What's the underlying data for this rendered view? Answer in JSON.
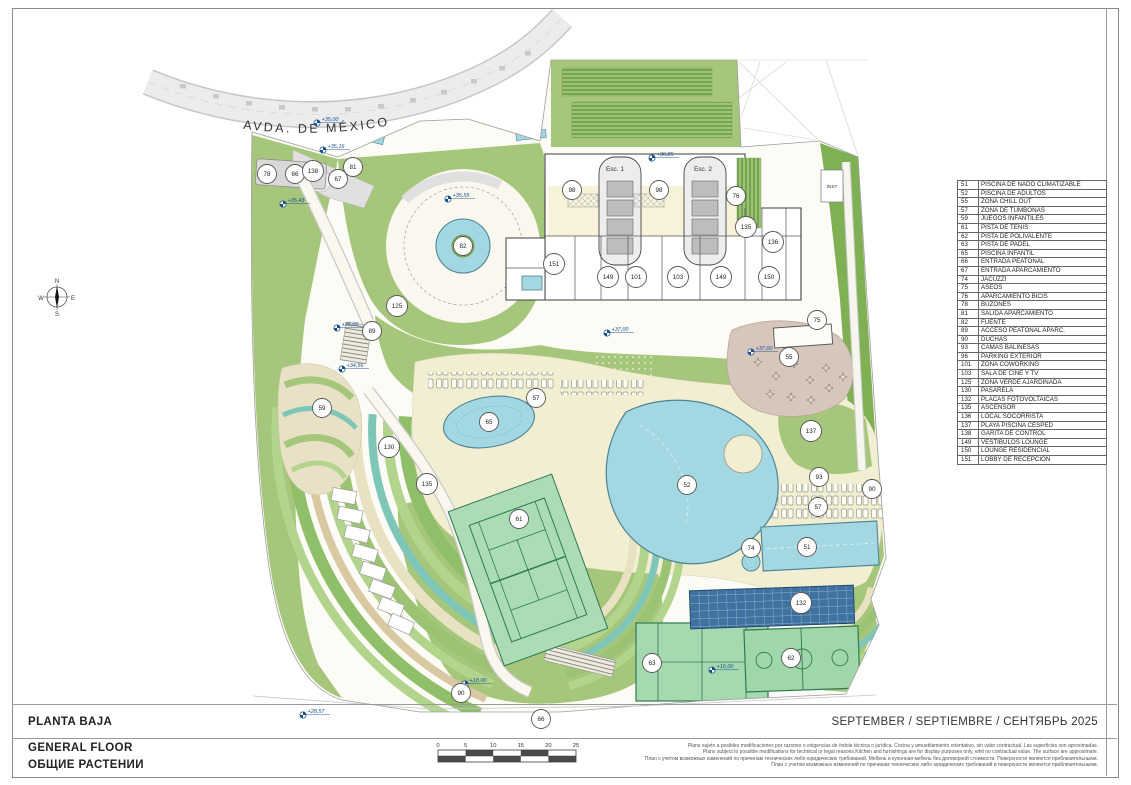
{
  "title_block": {
    "title_es": "PLANTA BAJA",
    "title_en": "GENERAL FLOOR",
    "title_ru": "ОБЩИЕ РАСТЕНИИ",
    "date_line": "SEPTEMBER / SEPTIEMBRE / СЕНТЯБРЬ 2025",
    "disclaimer_es": "Plano sujeto a posibles modificaciones por razones o exigencias de índole técnica o jurídica. Cocina y amueblamiento orientativo, sin valor contractual. Las superficies son aproximadas.",
    "disclaimer_en": "Plans subject to possible modifications for technical or legal reasons.Kitchen and furnishings are for display purposes only, whit no contractual value. The surface are approximate.",
    "disclaimer_ru1": "План с учетом возможных изменений по причинам технических либо юридических требований. Мебель и кухонная мебель без договорной стоимости. Поверхности являются приблизительными.",
    "disclaimer_ru2": "План с учетом возможных изменений по причинам технических либо юридических требований и поверхности являются приблизительными."
  },
  "scale_bar": {
    "ticks": [
      "0",
      "5",
      "10",
      "15",
      "20",
      "25"
    ]
  },
  "legend": {
    "rows": [
      {
        "n": "51",
        "t": "PISCINA DE NADO CLIMATIZABLE"
      },
      {
        "n": "52",
        "t": "PISCINA DE ADULTOS"
      },
      {
        "n": "55",
        "t": "ZONA CHILL OUT"
      },
      {
        "n": "57",
        "t": "ZONA DE TUMBONAS"
      },
      {
        "n": "59",
        "t": "JUEGOS INFANTILES"
      },
      {
        "n": "61",
        "t": "PISTA DE TENIS"
      },
      {
        "n": "62",
        "t": "PISTA DE POLIVALENTE"
      },
      {
        "n": "63",
        "t": "PISTA DE PADEL"
      },
      {
        "n": "65",
        "t": "PISCINA INFANTIL"
      },
      {
        "n": "66",
        "t": "ENTRADA PEATONAL"
      },
      {
        "n": "67",
        "t": "ENTRADA APARCAMIENTO"
      },
      {
        "n": "74",
        "t": "JACUZZI"
      },
      {
        "n": "75",
        "t": "ASEOS"
      },
      {
        "n": "76",
        "t": "APARCAMIENTO BICIS"
      },
      {
        "n": "78",
        "t": "BUZONES"
      },
      {
        "n": "81",
        "t": "SALIDA APARCAMIENTO"
      },
      {
        "n": "82",
        "t": "FUENTE"
      },
      {
        "n": "89",
        "t": "ACCESO PEATONAL APARC."
      },
      {
        "n": "90",
        "t": "DUCHAS"
      },
      {
        "n": "93",
        "t": "CAMAS BALINESAS"
      },
      {
        "n": "96",
        "t": "PARKING EXTERIOR"
      },
      {
        "n": "101",
        "t": "ZONA COWORKING"
      },
      {
        "n": "103",
        "t": "SALA DE CINE Y TV"
      },
      {
        "n": "125",
        "t": "ZONA VERDE AJARDINADA"
      },
      {
        "n": "130",
        "t": "PASARELA"
      },
      {
        "n": "132",
        "t": "PLACAS FOTOVOLTAICAS"
      },
      {
        "n": "135",
        "t": "ASCENSOR"
      },
      {
        "n": "136",
        "t": "LOCAL SOCORRISTA"
      },
      {
        "n": "137",
        "t": "PLAYA PISCINA CESPED"
      },
      {
        "n": "138",
        "t": "GARITA DE CONTROL"
      },
      {
        "n": "149",
        "t": "VESTÍBULOS LOUNGE"
      },
      {
        "n": "150",
        "t": "LOUNGE RESIDENCIAL"
      },
      {
        "n": "151",
        "t": "LOBBY DE RECEPCIÓN"
      }
    ]
  },
  "plan": {
    "street_label": "AVDA.  DE  MÉXICO",
    "compass": {
      "n": "N",
      "e": "E",
      "s": "S",
      "w": "W"
    },
    "labels": [
      {
        "t": "Esc. 1",
        "x": 615,
        "y": 171,
        "s": 6.5
      },
      {
        "t": "Esc. 2",
        "x": 703,
        "y": 171,
        "s": 6.5
      },
      {
        "t": "INST",
        "x": 832,
        "y": 188,
        "s": 4.8
      }
    ],
    "markers": [
      {
        "n": "78",
        "x": 267,
        "y": 174
      },
      {
        "n": "66",
        "x": 295,
        "y": 174
      },
      {
        "n": "138",
        "x": 313,
        "y": 171
      },
      {
        "n": "67",
        "x": 338,
        "y": 179
      },
      {
        "n": "81",
        "x": 353,
        "y": 167
      },
      {
        "n": "98",
        "x": 572,
        "y": 190
      },
      {
        "n": "98",
        "x": 659,
        "y": 190
      },
      {
        "n": "76",
        "x": 736,
        "y": 196
      },
      {
        "n": "135",
        "x": 746,
        "y": 227
      },
      {
        "n": "136",
        "x": 773,
        "y": 242
      },
      {
        "n": "151",
        "x": 554,
        "y": 264
      },
      {
        "n": "149",
        "x": 608,
        "y": 277
      },
      {
        "n": "101",
        "x": 636,
        "y": 277
      },
      {
        "n": "103",
        "x": 678,
        "y": 277
      },
      {
        "n": "149",
        "x": 721,
        "y": 277
      },
      {
        "n": "150",
        "x": 769,
        "y": 277
      },
      {
        "n": "82",
        "x": 463,
        "y": 246
      },
      {
        "n": "125",
        "x": 397,
        "y": 306
      },
      {
        "n": "89",
        "x": 372,
        "y": 331
      },
      {
        "n": "75",
        "x": 817,
        "y": 320
      },
      {
        "n": "55",
        "x": 789,
        "y": 357
      },
      {
        "n": "59",
        "x": 322,
        "y": 408
      },
      {
        "n": "57",
        "x": 536,
        "y": 398
      },
      {
        "n": "65",
        "x": 489,
        "y": 422
      },
      {
        "n": "137",
        "x": 811,
        "y": 431
      },
      {
        "n": "130",
        "x": 389,
        "y": 447
      },
      {
        "n": "135",
        "x": 427,
        "y": 484
      },
      {
        "n": "52",
        "x": 687,
        "y": 485
      },
      {
        "n": "93",
        "x": 819,
        "y": 477
      },
      {
        "n": "90",
        "x": 872,
        "y": 489
      },
      {
        "n": "57",
        "x": 818,
        "y": 507
      },
      {
        "n": "74",
        "x": 751,
        "y": 548
      },
      {
        "n": "51",
        "x": 807,
        "y": 547
      },
      {
        "n": "61",
        "x": 519,
        "y": 519
      },
      {
        "n": "132",
        "x": 801,
        "y": 603
      },
      {
        "n": "63",
        "x": 652,
        "y": 663
      },
      {
        "n": "62",
        "x": 791,
        "y": 658
      },
      {
        "n": "90",
        "x": 461,
        "y": 693
      },
      {
        "n": "66",
        "x": 541,
        "y": 719
      }
    ],
    "elevations": [
      {
        "t": "+35,00",
        "x": 317,
        "y": 123
      },
      {
        "t": "+35,16",
        "x": 323,
        "y": 150
      },
      {
        "t": "+35,43",
        "x": 283,
        "y": 204
      },
      {
        "t": "+35,55",
        "x": 448,
        "y": 199
      },
      {
        "t": "+36,85",
        "x": 652,
        "y": 158
      },
      {
        "t": "+35,00",
        "x": 337,
        "y": 328
      },
      {
        "t": "+34,56",
        "x": 342,
        "y": 369
      },
      {
        "t": "+37,00",
        "x": 607,
        "y": 333
      },
      {
        "t": "+37,00",
        "x": 751,
        "y": 352
      },
      {
        "t": "+16,00",
        "x": 712,
        "y": 670
      },
      {
        "t": "+18,00",
        "x": 465,
        "y": 684
      },
      {
        "t": "+28,57",
        "x": 303,
        "y": 715
      }
    ]
  },
  "colors": {
    "green": "#a6c77b",
    "dark_green": "#7fb054",
    "teal": "#7ec6b8",
    "pool_blue": "#a3d8e2",
    "pool_edge": "#4d8494",
    "deck_cream": "#f2eed2",
    "plaza_tan": "#d6c6bc",
    "court_green": "#a5d9b0",
    "solar_blue": "#3f72a0",
    "elevation_blue": "#17508c"
  }
}
